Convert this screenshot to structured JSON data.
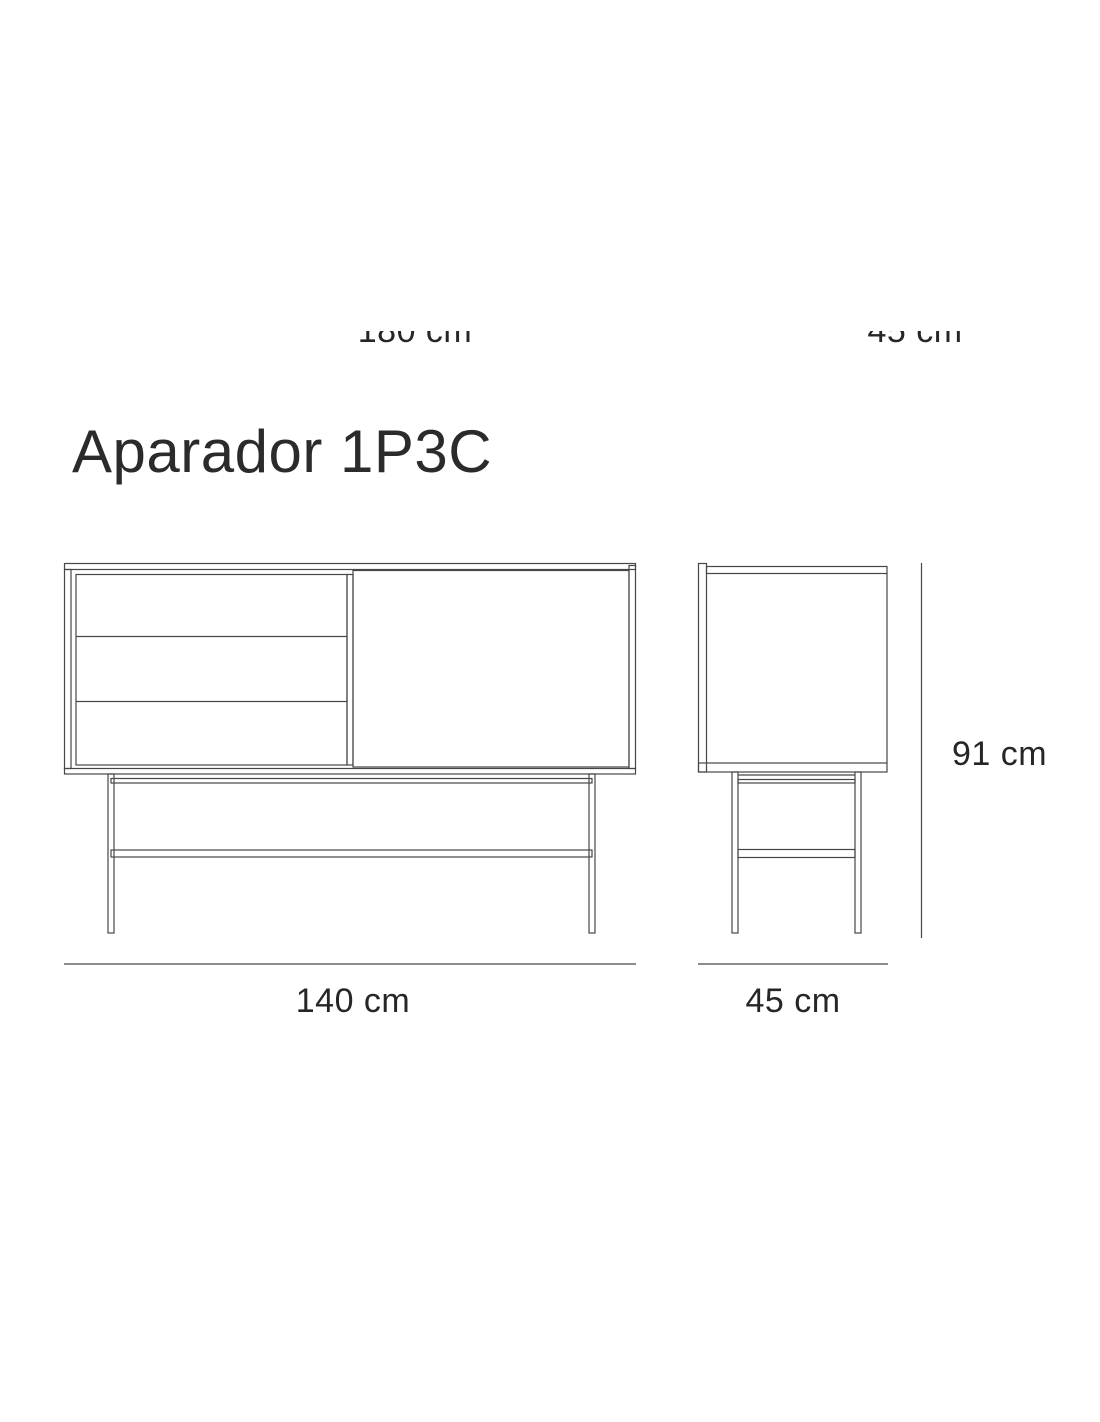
{
  "page": {
    "title": "Aparador 1P3C"
  },
  "colors": {
    "background": "#ffffff",
    "line": "#474747",
    "text": "#262626",
    "title_text": "#2b2b2b"
  },
  "top_clipped_labels": {
    "left": "180 cm",
    "right": "45 cm"
  },
  "front_view": {
    "width_label": "140 cm",
    "drawers_count": 3,
    "doors_count": 1
  },
  "side_view": {
    "depth_label": "45 cm",
    "height_label": "91 cm"
  }
}
